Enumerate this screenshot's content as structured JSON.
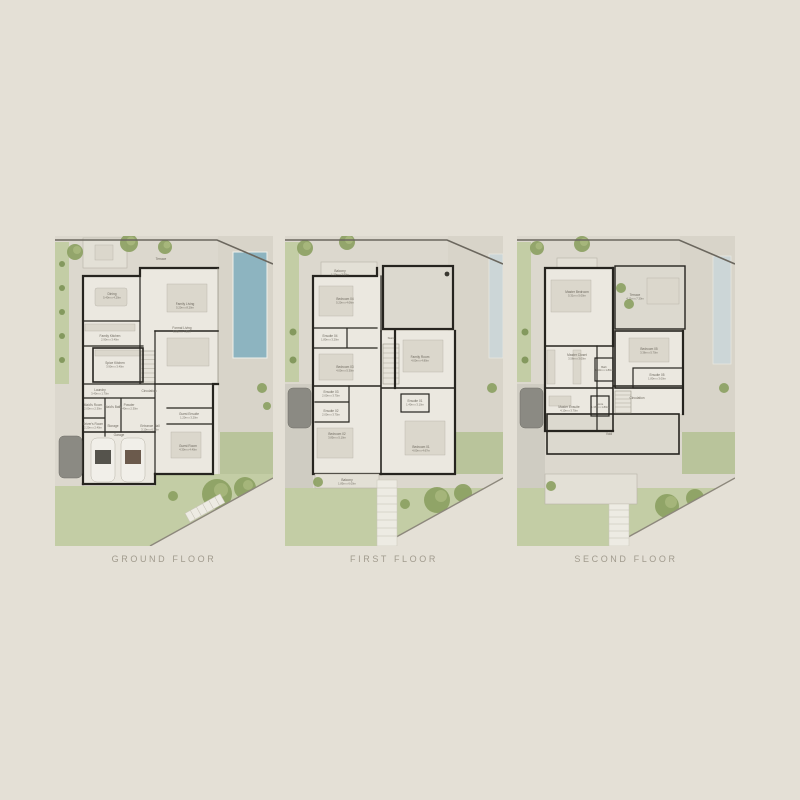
{
  "sheet": {
    "background": "#e4e0d6"
  },
  "colors": {
    "page": "#e4e0d6",
    "paving": "#dcd8ce",
    "lawn": "#c3cda5",
    "interior": "#ebe8e0",
    "wall": "#26241f",
    "pool": "#8db4c0",
    "pool_pale": "#ccd6d7",
    "tree": "#8ba061",
    "label_text": "#6f6a60",
    "caption_text": "#a19b8e"
  },
  "plans": [
    {
      "caption": "GROUND FLOOR",
      "labels": [
        {
          "name": "Terrace",
          "dims": ""
        },
        {
          "name": "Dining",
          "dims": "5.40m x 4.20m"
        },
        {
          "name": "Family Living",
          "dims": "5.20m x 8.20m"
        },
        {
          "name": "Formal Living",
          "dims": "5.80m x 4.80m"
        },
        {
          "name": "Family Kitchen",
          "dims": "2.90m x 3.40m"
        },
        {
          "name": "Spice Kitchen",
          "dims": "3.90m x 3.40m"
        },
        {
          "name": "Laundry",
          "dims": "3.40m x 1.70m"
        },
        {
          "name": "Maid's Room",
          "dims": "2.00m x 2.30m"
        },
        {
          "name": "Maid's Bath",
          "dims": ""
        },
        {
          "name": "Powder",
          "dims": "1.40m x 2.30m"
        },
        {
          "name": "Driver's Room",
          "dims": "2.20m x 2.40m"
        },
        {
          "name": "Storage",
          "dims": ""
        },
        {
          "name": "Entrance Hall",
          "dims": "3.10m x 6.35m"
        },
        {
          "name": "Circulation",
          "dims": ""
        },
        {
          "name": "Guest Ensuite",
          "dims": "1.20m x 3.20m"
        },
        {
          "name": "Guest Room",
          "dims": "4.30m x 4.40m"
        },
        {
          "name": "Garage",
          "dims": ""
        }
      ]
    },
    {
      "caption": "FIRST FLOOR",
      "labels": [
        {
          "name": "Balcony",
          "dims": "1.20m x 3.50m"
        },
        {
          "name": "Bedroom 04",
          "dims": "5.20m x 4.06m"
        },
        {
          "name": "Ensuite 04",
          "dims": "1.80m x 3.20m"
        },
        {
          "name": "Bedroom 03",
          "dims": "4.00m x 5.30m"
        },
        {
          "name": "Ensuite 03",
          "dims": "2.00m x 3.75m"
        },
        {
          "name": "Ensuite 02",
          "dims": "2.00m x 3.75m"
        },
        {
          "name": "Bedroom 02",
          "dims": "3.85m x 5.10m"
        },
        {
          "name": "Balcony",
          "dims": "1.85m x 6.00m"
        },
        {
          "name": "Family Room",
          "dims": "4.00m x 4.80m"
        },
        {
          "name": "Ensuite 01",
          "dims": "1.40m x 3.10m"
        },
        {
          "name": "Bedroom 01",
          "dims": "4.00m x 4.67m"
        },
        {
          "name": "Stairs",
          "dims": ""
        }
      ]
    },
    {
      "caption": "SECOND FLOOR",
      "labels": [
        {
          "name": "Master Bedroom",
          "dims": "5.31m x 5.00m"
        },
        {
          "name": "Terrace",
          "dims": "4.11m x 7.30m"
        },
        {
          "name": "Master Closet",
          "dims": "3.56m x 3.00m"
        },
        {
          "name": "Bedroom 05",
          "dims": "3.36m x 5.70m"
        },
        {
          "name": "Ensuite 05",
          "dims": "1.80m x 3.00m"
        },
        {
          "name": "Bath",
          "dims": "1.40m x 1.80m"
        },
        {
          "name": "Master Ensuite",
          "dims": "4.10m x 3.70m"
        },
        {
          "name": "Circulation",
          "dims": ""
        },
        {
          "name": "Store",
          "dims": "1.36m x 1.80m"
        },
        {
          "name": "Void",
          "dims": ""
        }
      ]
    }
  ]
}
